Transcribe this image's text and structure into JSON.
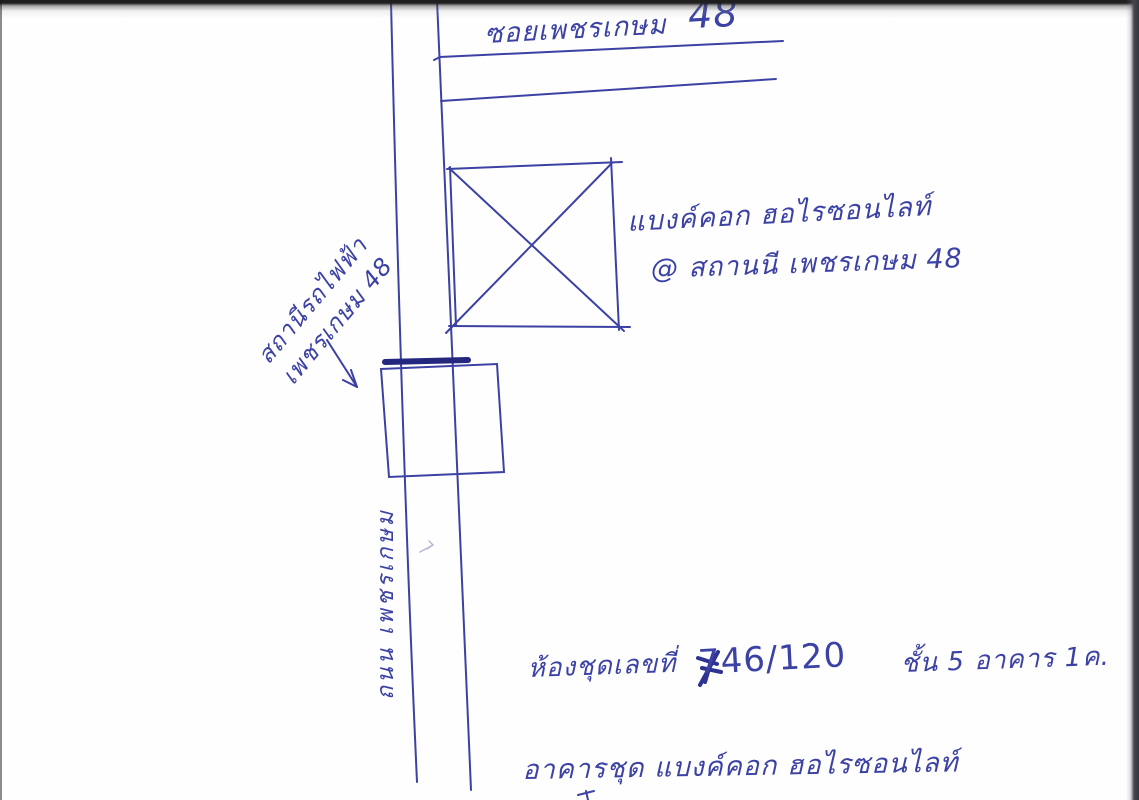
{
  "colors": {
    "paper": "#fefefe",
    "ink": "#3c42a4",
    "heavy_ink": "#23277e",
    "scan_edge": "#33363b"
  },
  "sketch": {
    "soi_label": {
      "text": "ซอยเพชรเกษม",
      "number": "48"
    },
    "condo_label": {
      "line1": "แบงค์คอก ฮอไรซอนไลท์",
      "line2": "@ สถานนี เพชรเกษม 48"
    },
    "station_label": {
      "line1": "สถานีรถไฟฟ้า",
      "line2": "เพชรเกษม 48"
    },
    "road_label": "ถนน เพชรเกษม",
    "unit_label": {
      "prefix": "ห้องชุดเลขที่",
      "number": "746/120",
      "floor_building": "ชั้น 5 อาคาร 1ค."
    },
    "building_label": "อาคารชุด แบงค์คอก ฮอไรซอนไลท์"
  }
}
